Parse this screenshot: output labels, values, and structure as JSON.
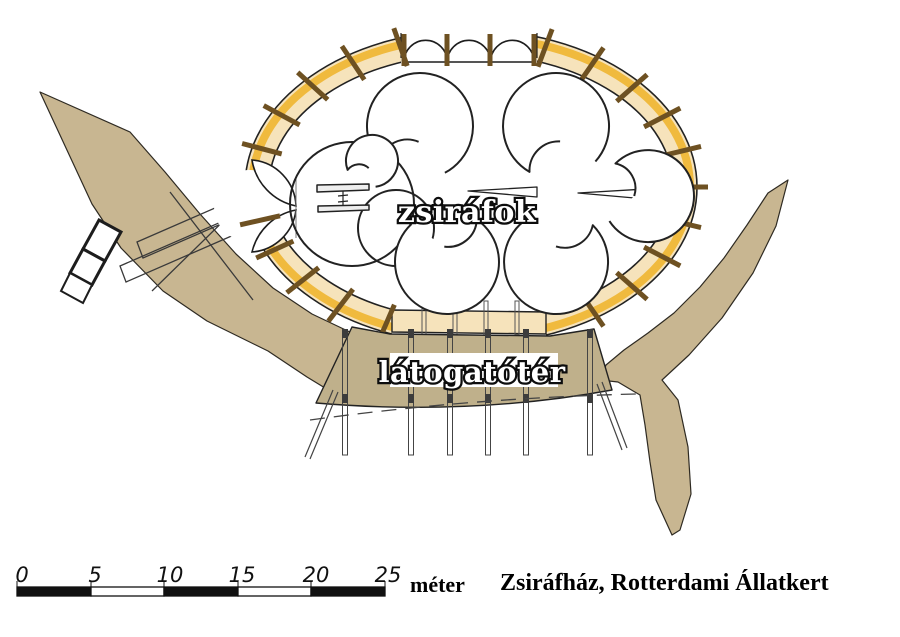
{
  "caption": "Zsiráfház, Rotterdami Állatkert",
  "plan": {
    "enclosure_label": "zsiráfok",
    "visitor_area_label": "látogatótér"
  },
  "scale_bar": {
    "ticks": [
      "0",
      "5",
      "10",
      "15",
      "20",
      "25"
    ],
    "unit": "méter"
  },
  "colors": {
    "walkway": "#c8b691",
    "platform": "#bfb08b",
    "ring_fill": "#f6e3bb",
    "ring_accent": "#f0ba3e",
    "post_brown": "#6e5122",
    "ink": "#222222"
  }
}
